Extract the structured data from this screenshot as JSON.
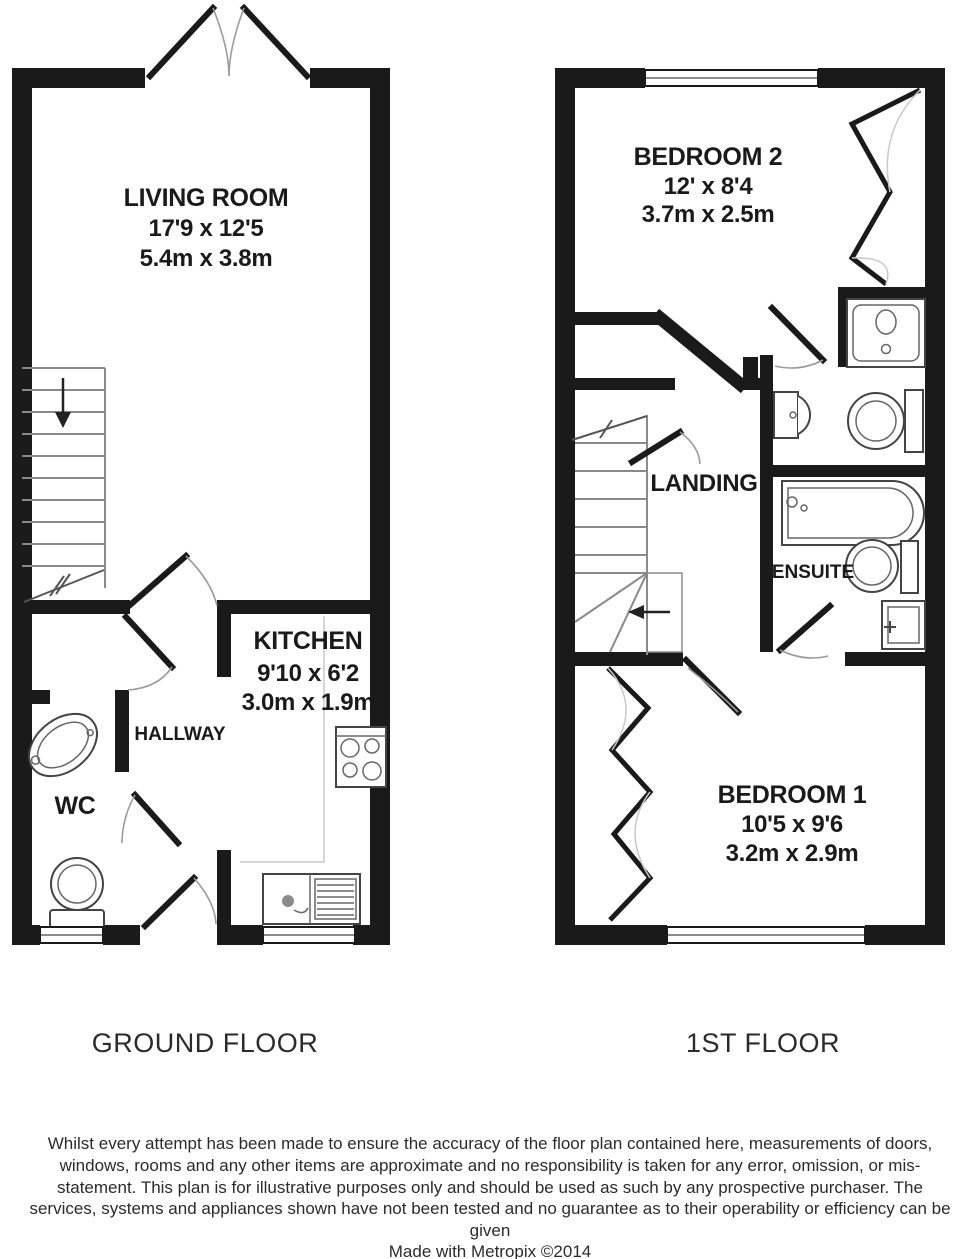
{
  "plans": {
    "ground_floor": {
      "label": "GROUND FLOOR",
      "rooms": {
        "living_room": {
          "name": "LIVING ROOM",
          "imperial": "17'9 x 12'5",
          "metric": "5.4m x 3.8m"
        },
        "kitchen": {
          "name": "KITCHEN",
          "imperial": "9'10 x 6'2",
          "metric": "3.0m x 1.9m"
        },
        "hallway": {
          "name": "HALLWAY"
        },
        "wc": {
          "name": "WC"
        }
      }
    },
    "first_floor": {
      "label": "1ST FLOOR",
      "rooms": {
        "bedroom2": {
          "name": "BEDROOM 2",
          "imperial": "12' x 8'4",
          "metric": "3.7m x 2.5m"
        },
        "bedroom1": {
          "name": "BEDROOM 1",
          "imperial": "10'5 x 9'6",
          "metric": "3.2m x 2.9m"
        },
        "landing": {
          "name": "LANDING"
        },
        "ensuite": {
          "name": "ENSUITE"
        }
      }
    }
  },
  "footer": {
    "disclaimer": "Whilst every attempt has been made to ensure the accuracy of the floor plan contained here, measurements of doors, windows, rooms and any other items are approximate and no responsibility is taken for any error, omission, or mis-statement. This plan is for illustrative purposes only and should be used as such by any prospective purchaser. The services, systems and appliances shown have not been tested and no guarantee as to their operability or efficiency can be given",
    "credit": "Made with Metropix ©2014"
  },
  "colors": {
    "wall": "#1a1a1a",
    "fixture_stroke": "#444444",
    "faint_line": "#9a9a9a",
    "text": "#1a1a1a",
    "background": "#ffffff"
  }
}
